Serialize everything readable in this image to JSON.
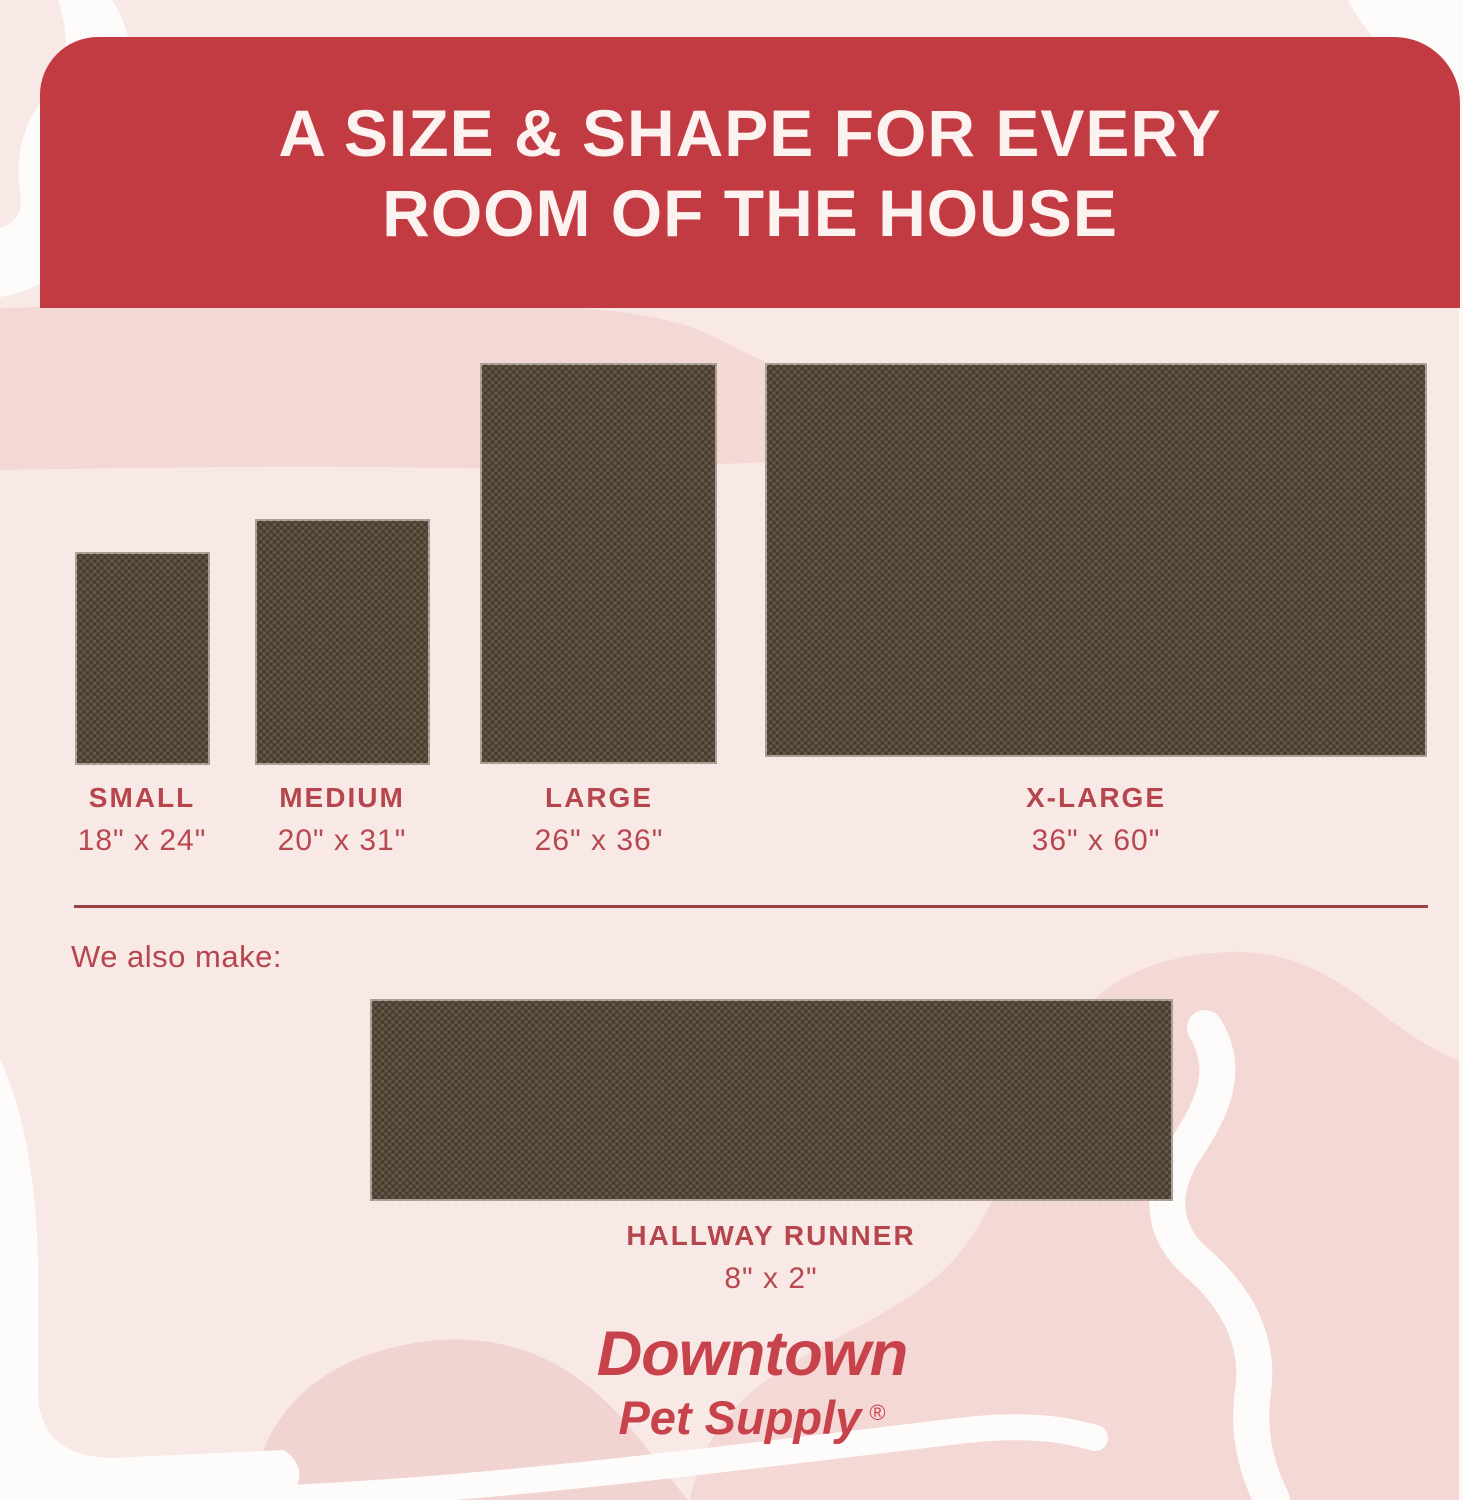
{
  "header": {
    "title_line1": "A SIZE & SHAPE FOR EVERY",
    "title_line2": "ROOM OF THE HOUSE"
  },
  "sizes": [
    {
      "name": "SMALL",
      "dimensions": "18\" x 24\""
    },
    {
      "name": "MEDIUM",
      "dimensions": "20\" x 31\""
    },
    {
      "name": "LARGE",
      "dimensions": "26\" x 36\""
    },
    {
      "name": "X-LARGE",
      "dimensions": "36\" x 60\""
    }
  ],
  "also_make": {
    "intro": "We also make:",
    "name": "HALLWAY RUNNER",
    "dimensions": "8\" x 2\""
  },
  "brand": {
    "line1": "Downtown",
    "line2": "Pet Supply",
    "mark": "®"
  },
  "colors": {
    "banner_red": "#c23b42",
    "header_text": "#fcf3f1",
    "label_red": "#b5464d",
    "divider_red": "#9a4343",
    "logo_red": "#c7424b",
    "mat_brown": "#473c31",
    "mat_dot": "#8f7c60",
    "background_pink": "#f8e9e7",
    "blob_pink": "#f4d8d5",
    "ribbon_white": "#fefcfb"
  }
}
